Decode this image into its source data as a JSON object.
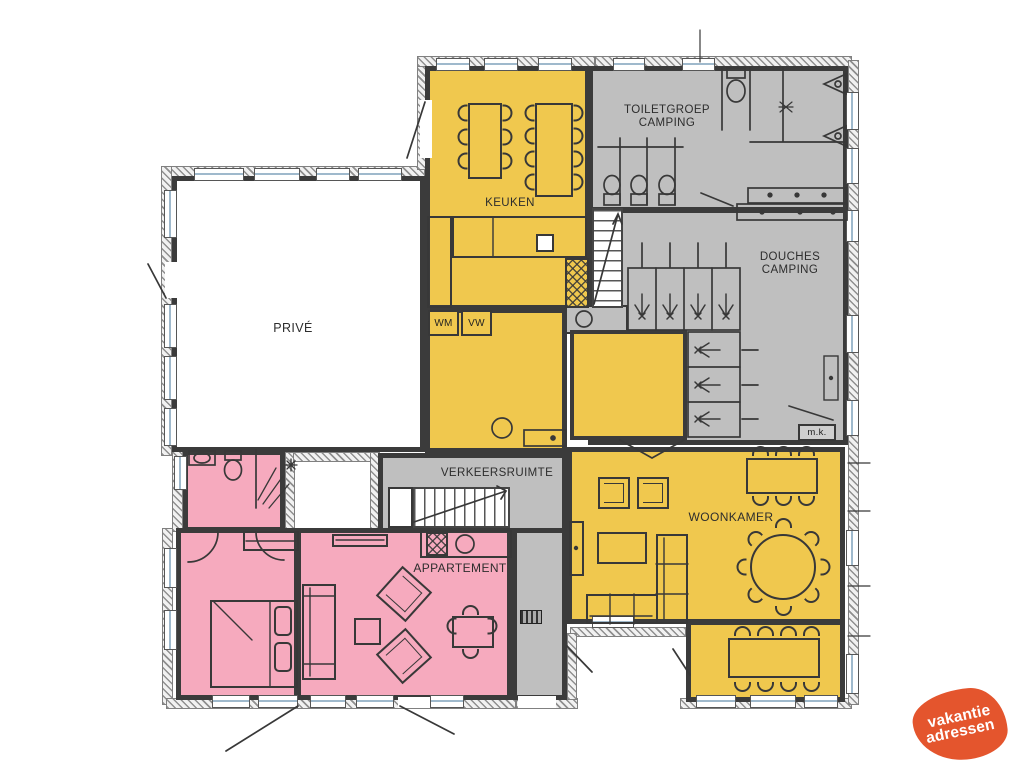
{
  "title": "floorplan",
  "colors": {
    "room_yellow": "#F0C84E",
    "room_gray": "#BFBFBF",
    "room_pink": "#F6AABE",
    "wall_dark": "#3b3b3b",
    "logo_orange": "#E4552D",
    "window_glass": "#9FB9CC",
    "label_text": "#2d2d2d"
  },
  "rooms": {
    "prive": {
      "label": "PRIVÉ"
    },
    "keuken": {
      "label": "KEUKEN"
    },
    "toiletgroep": {
      "line1": "TOILETGROEP",
      "line2": "CAMPING"
    },
    "douches": {
      "line1": "DOUCHES",
      "line2": "CAMPING"
    },
    "verkeersruimte": {
      "label": "VERKEERSRUIMTE"
    },
    "appartement": {
      "label": "APPARTEMENT"
    },
    "woonkamer": {
      "label": "WOONKAMER"
    },
    "laundry": {
      "wm": "WM",
      "vw": "VW"
    },
    "mk": {
      "label": "m.k."
    }
  },
  "logo": {
    "line1": "vakantie",
    "line2": "adressen"
  }
}
